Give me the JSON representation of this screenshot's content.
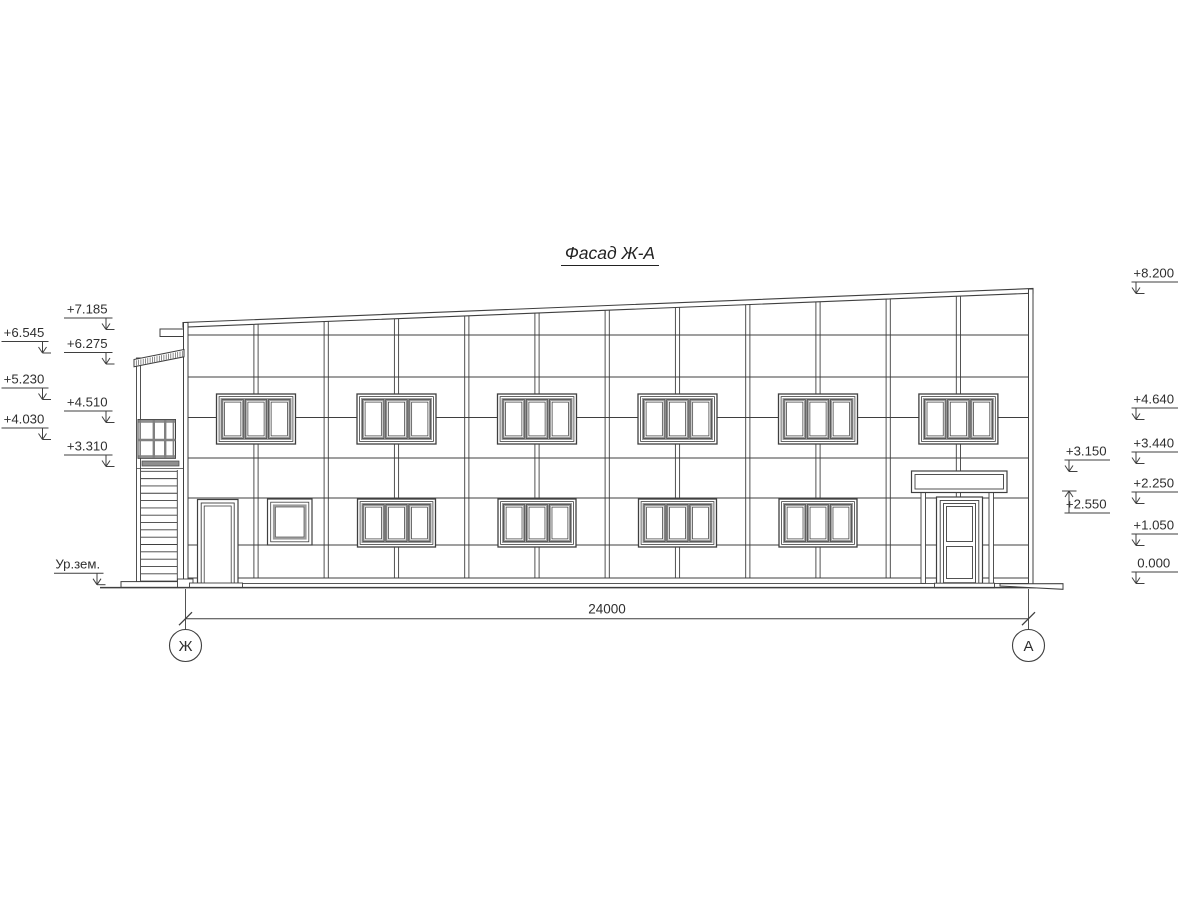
{
  "title": "Фасад Ж-А",
  "dimension": {
    "total_width_label": "24000"
  },
  "axes": {
    "left": "Ж",
    "right": "А"
  },
  "ground_level_label": "Ур.зем.",
  "elevation_marks": {
    "left_inner": [
      "+7.185",
      "+6.275",
      "+4.510",
      "+3.310"
    ],
    "left_outer": [
      "+6.545",
      "+5.230",
      "+4.030"
    ],
    "right_outer": [
      "+8.200",
      "+4.640",
      "+3.440",
      "+2.250",
      "+1.050",
      "0.000"
    ],
    "right_inner": [
      "+3.150",
      "+2.550"
    ]
  },
  "colors": {
    "ink": "#3f3f3f",
    "sash_gray": "#9c9c9c",
    "dark_fill": "#8f8f8f"
  }
}
